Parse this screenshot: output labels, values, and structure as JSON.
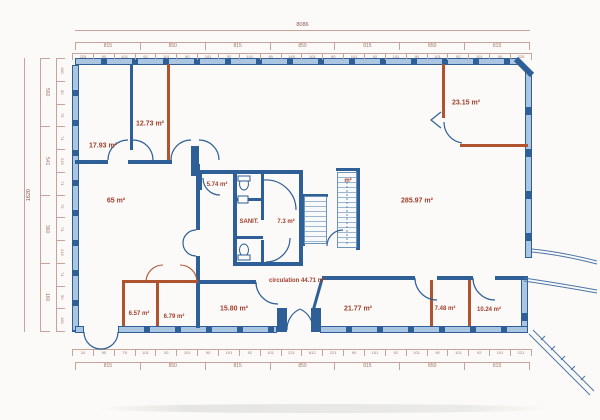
{
  "rooms": [
    {
      "name": "room-17-93",
      "label": "17.93 m²"
    },
    {
      "name": "room-12-73",
      "label": "12.73 m²"
    },
    {
      "name": "room-23-15",
      "label": "23.15 m²"
    },
    {
      "name": "room-65",
      "label": "65 m²"
    },
    {
      "name": "room-5-74",
      "label": "5.74 m²"
    },
    {
      "name": "sanitaires",
      "label": "SANIT."
    },
    {
      "name": "room-7-3",
      "label": "7.3 m²"
    },
    {
      "name": "room-285-97",
      "label": "285.97 m²"
    },
    {
      "name": "stairs-area",
      "label": "m²"
    },
    {
      "name": "circulation",
      "label": "circulation 44.71 m²"
    },
    {
      "name": "room-6-57",
      "label": "6.57 m²"
    },
    {
      "name": "room-6-79",
      "label": "6.79 m²"
    },
    {
      "name": "room-15-80",
      "label": "15.80 m²"
    },
    {
      "name": "room-21-77",
      "label": "21.77 m²"
    },
    {
      "name": "room-7-48",
      "label": "7.48 m²"
    },
    {
      "name": "room-10-24",
      "label": "10.24 m²"
    }
  ],
  "dims": {
    "top_total": "8086",
    "top_segments": [
      "815",
      "850",
      "815",
      "850",
      "815",
      "850",
      "815"
    ],
    "top_ticks": [
      "225",
      "90",
      "101",
      "92",
      "101",
      "90",
      "101",
      "92",
      "101",
      "90",
      "145",
      "101",
      "90",
      "101",
      "92",
      "101",
      "90",
      "101",
      "92",
      "101",
      "90",
      "225"
    ],
    "bottom_ticks": [
      "24",
      "90",
      "75",
      "101",
      "92",
      "101",
      "90",
      "101",
      "92",
      "101",
      "221",
      "812",
      "221",
      "90",
      "101",
      "92",
      "101",
      "90",
      "101",
      "92",
      "101",
      "221"
    ],
    "bottom_segments": [
      "815",
      "850",
      "815",
      "850",
      "815",
      "850",
      "815"
    ],
    "left_total": "1620",
    "left_segments": [
      "560",
      "541",
      "360",
      "160"
    ],
    "left_ticks": [
      "160",
      "90",
      "75",
      "74",
      "215",
      "74",
      "75",
      "74",
      "215",
      "74",
      "90",
      "160"
    ]
  },
  "colors": {
    "wall": "#2e5f96",
    "window": "#aac6e2",
    "partition": "#b0532f",
    "room_label": "#a23f2c",
    "dimension": "#a5746a",
    "paper": "#fbfaf8"
  }
}
